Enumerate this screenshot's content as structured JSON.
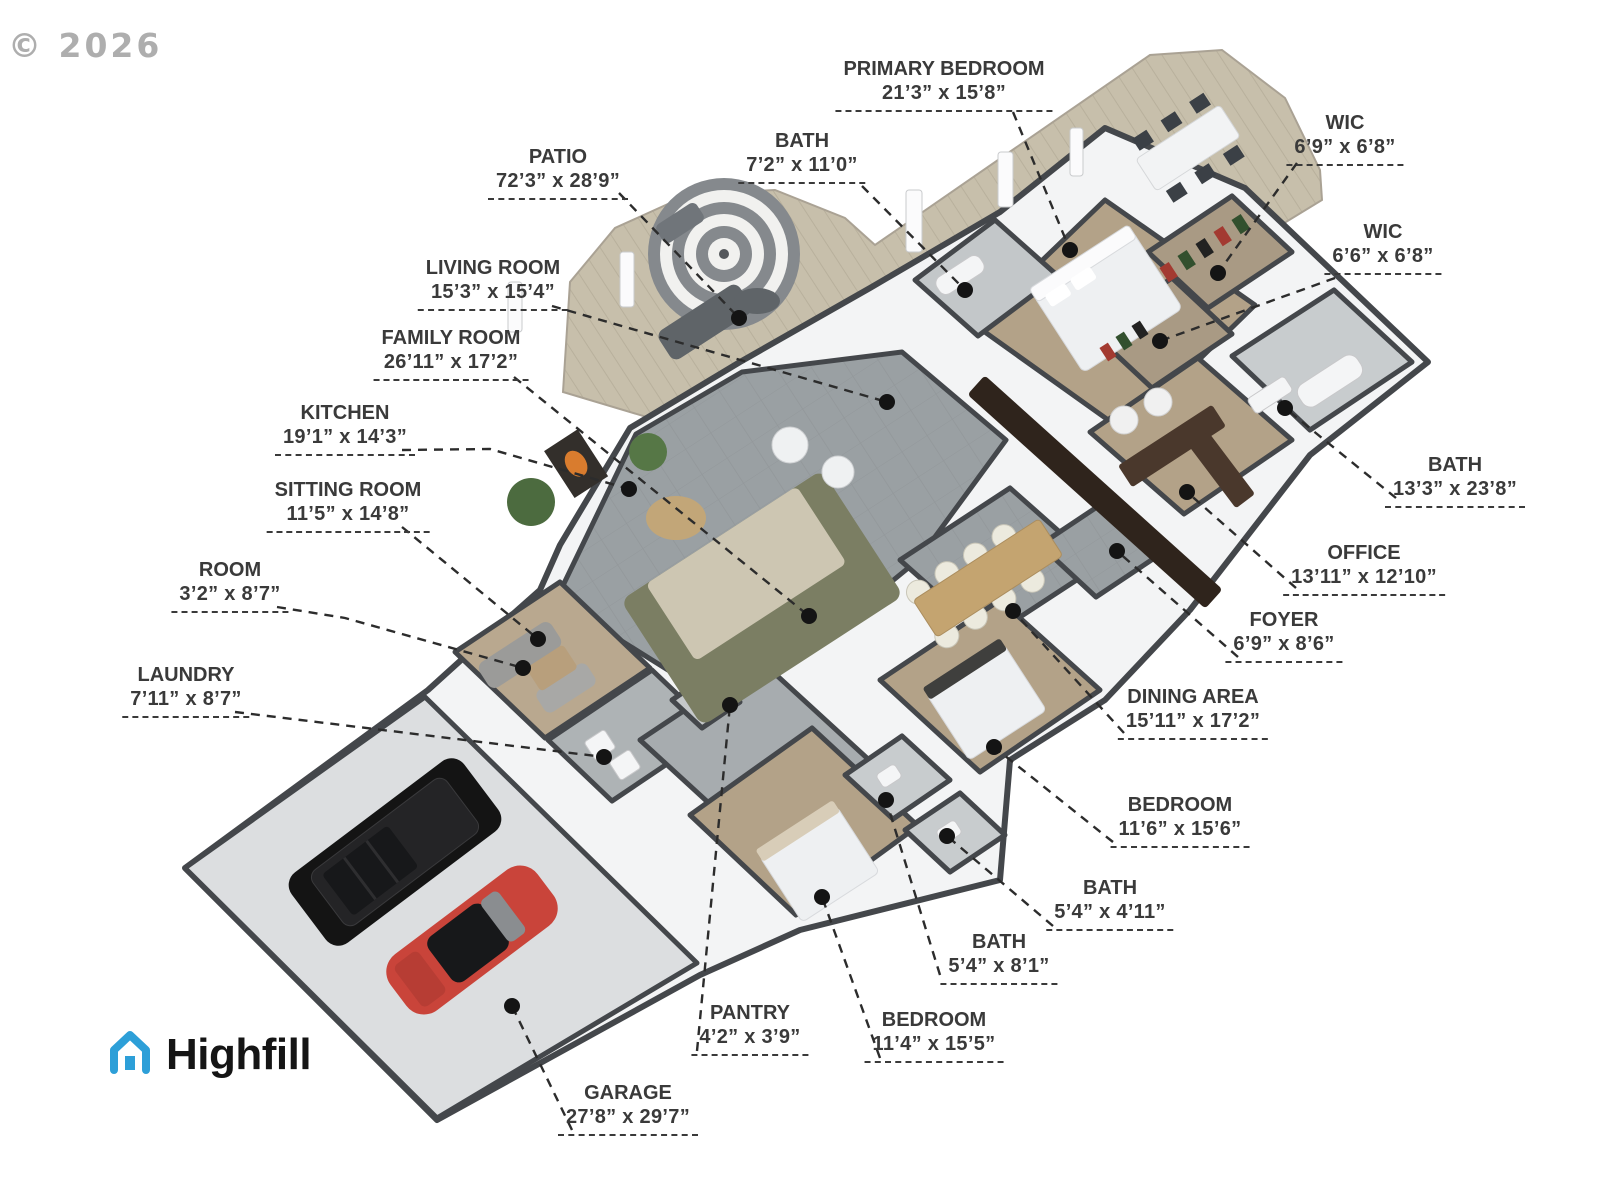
{
  "copyright": "© 2026",
  "logo": {
    "text": "Highfill",
    "icon": "house-icon",
    "brand_color": "#2d9fd8",
    "text_color": "#151515"
  },
  "colors": {
    "label": "#3a3a3a",
    "leader": "#2c2c2c",
    "copyright": "#9a9a9a",
    "brand_blue": "#2d9fd8",
    "deck_tan": "#c7bfab",
    "tile_gray": "#9aa0a3",
    "carpet_tan": "#b3a288",
    "bath_tile": "#c8ccce",
    "garage_concrete": "#dcdee0",
    "wall_top": "#44474b",
    "wall_white": "#f3f4f5",
    "suv_black": "#141414",
    "sportscar_red": "#c9443a",
    "sofa_olive": "#7b7e63"
  },
  "labels": [
    {
      "room": "PRIMARY BEDROOM",
      "size": "21’3” x 15’8”",
      "x": 944,
      "y": 58,
      "leader": [
        [
          1013,
          112
        ],
        [
          1070,
          250
        ]
      ]
    },
    {
      "room": "BATH",
      "size": "7’2” x 11’0”",
      "x": 802,
      "y": 130,
      "leader": [
        [
          862,
          186
        ],
        [
          965,
          290
        ]
      ]
    },
    {
      "room": "WIC",
      "size": "6’9” x 6’8”",
      "x": 1345,
      "y": 112,
      "leader": [
        [
          1297,
          163
        ],
        [
          1218,
          273
        ]
      ]
    },
    {
      "room": "WIC",
      "size": "6’6” x 6’8”",
      "x": 1383,
      "y": 221,
      "leader": [
        [
          1335,
          278
        ],
        [
          1160,
          341
        ]
      ]
    },
    {
      "room": "PATIO",
      "size": "72’3” x 28’9”",
      "x": 558,
      "y": 146,
      "leader": [
        [
          619,
          193
        ],
        [
          739,
          318
        ]
      ]
    },
    {
      "room": "LIVING ROOM",
      "size": "15’3” x 15’4”",
      "x": 493,
      "y": 257,
      "leader": [
        [
          552,
          306
        ],
        [
          887,
          402
        ]
      ]
    },
    {
      "room": "FAMILY ROOM",
      "size": "26’11” x 17’2”",
      "x": 451,
      "y": 327,
      "leader": [
        [
          514,
          377
        ],
        [
          809,
          616
        ]
      ]
    },
    {
      "room": "KITCHEN",
      "size": "19’1” x 14’3”",
      "x": 345,
      "y": 402,
      "leader": [
        [
          402,
          450
        ],
        [
          490,
          449
        ],
        [
          629,
          489
        ]
      ]
    },
    {
      "room": "SITTING ROOM",
      "size": "11’5” x 14’8”",
      "x": 348,
      "y": 479,
      "leader": [
        [
          402,
          527
        ],
        [
          538,
          639
        ]
      ]
    },
    {
      "room": "ROOM",
      "size": "3’2” x 8’7”",
      "x": 230,
      "y": 559,
      "leader": [
        [
          277,
          607
        ],
        [
          345,
          618
        ],
        [
          523,
          668
        ]
      ]
    },
    {
      "room": "LAUNDRY",
      "size": "7’11” x 8’7”",
      "x": 186,
      "y": 664,
      "leader": [
        [
          235,
          712
        ],
        [
          604,
          757
        ]
      ]
    },
    {
      "room": "BATH",
      "size": "13’3” x 23’8”",
      "x": 1455,
      "y": 454,
      "leader": [
        [
          1396,
          498
        ],
        [
          1285,
          408
        ]
      ]
    },
    {
      "room": "OFFICE",
      "size": "13’11” x 12’10”",
      "x": 1364,
      "y": 542,
      "leader": [
        [
          1296,
          588
        ],
        [
          1187,
          492
        ]
      ]
    },
    {
      "room": "FOYER",
      "size": "6’9” x 8’6”",
      "x": 1284,
      "y": 609,
      "leader": [
        [
          1238,
          657
        ],
        [
          1117,
          551
        ]
      ]
    },
    {
      "room": "DINING AREA",
      "size": "15’11” x 17’2”",
      "x": 1193,
      "y": 686,
      "leader": [
        [
          1124,
          733
        ],
        [
          1013,
          611
        ]
      ]
    },
    {
      "room": "BEDROOM",
      "size": "11’6” x 15’6”",
      "x": 1180,
      "y": 794,
      "leader": [
        [
          1113,
          842
        ],
        [
          994,
          747
        ]
      ]
    },
    {
      "room": "BATH",
      "size": "5’4” x 4’11”",
      "x": 1110,
      "y": 877,
      "leader": [
        [
          1053,
          926
        ],
        [
          947,
          836
        ]
      ]
    },
    {
      "room": "BATH",
      "size": "5’4” x 8’1”",
      "x": 999,
      "y": 931,
      "leader": [
        [
          940,
          975
        ],
        [
          886,
          800
        ]
      ]
    },
    {
      "room": "BEDROOM",
      "size": "11’4” x 15’5”",
      "x": 934,
      "y": 1009,
      "leader": [
        [
          880,
          1058
        ],
        [
          822,
          897
        ]
      ]
    },
    {
      "room": "PANTRY",
      "size": "4’2” x 3’9”",
      "x": 750,
      "y": 1002,
      "leader": [
        [
          697,
          1051
        ],
        [
          730,
          705
        ]
      ]
    },
    {
      "room": "GARAGE",
      "size": "27’8” x 29’7”",
      "x": 628,
      "y": 1082,
      "leader": [
        [
          572,
          1130
        ],
        [
          512,
          1006
        ]
      ]
    }
  ]
}
